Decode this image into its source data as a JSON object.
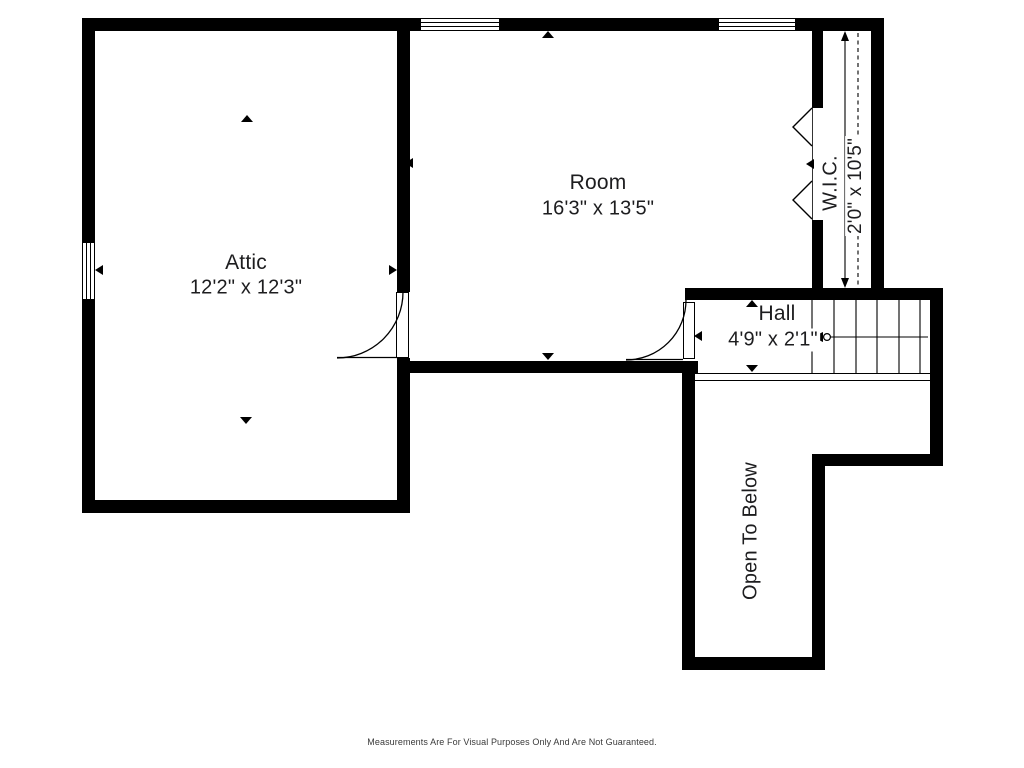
{
  "colors": {
    "wall": "#000000",
    "bg": "#ffffff",
    "text": "#1d1d1f",
    "muted": "#3a3a3a"
  },
  "labels": {
    "attic": {
      "name": "Attic",
      "dims": "12'2\" x 12'3\""
    },
    "room": {
      "name": "Room",
      "dims": "16'3\" x 13'5\""
    },
    "hall": {
      "name": "Hall",
      "dims": "4'9\" x 2'1\""
    },
    "wic": {
      "name": "W.I.C.",
      "dims": "2'0\" x 10'5\""
    },
    "open_to_below": {
      "name": "Open To Below"
    }
  },
  "footer": {
    "disclaimer": "Measurements Are For Visual Purposes Only And Are Not Guaranteed."
  }
}
